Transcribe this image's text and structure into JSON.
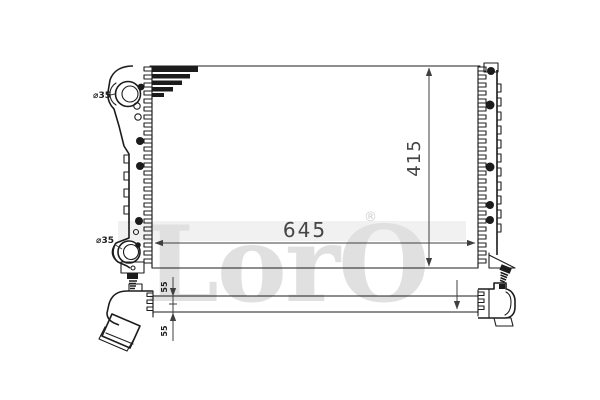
{
  "drawing": {
    "type": "radiator-technical-drawing",
    "views": [
      "front-view",
      "bottom-side-view"
    ],
    "labels": {
      "core_width": "645",
      "core_height": "415",
      "inlet_diameter": "⌀35",
      "outlet_diameter": "⌀35",
      "pipe_offset_top": "55",
      "pipe_offset_bottom": "55"
    },
    "watermark": {
      "text": "LorO",
      "registered": "®"
    },
    "colors": {
      "background": "#ffffff",
      "line": "#1d1d1d",
      "dimension_text": "#454545",
      "watermark": "#e0e0e0"
    }
  }
}
